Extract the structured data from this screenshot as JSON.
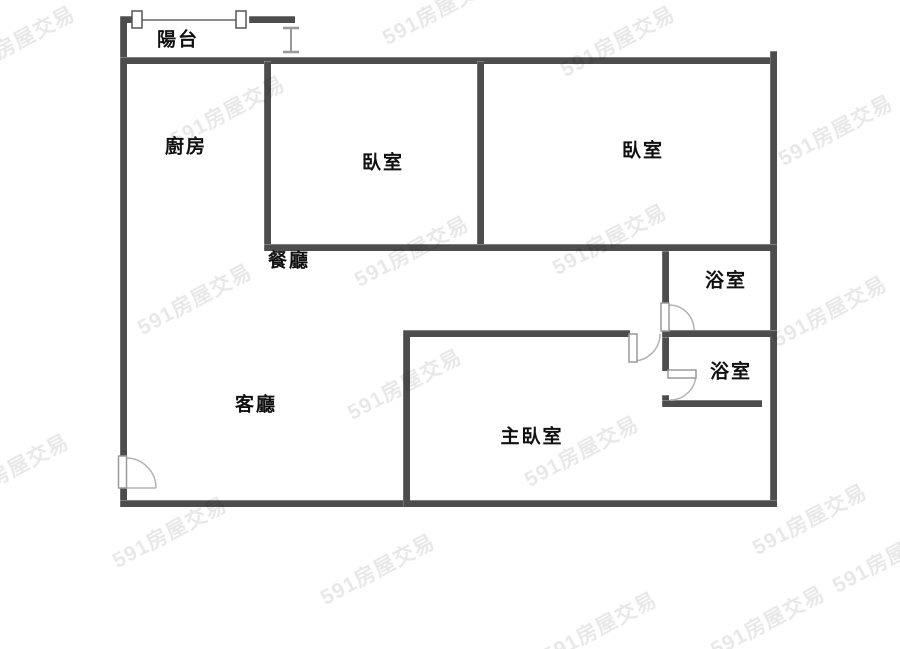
{
  "page": {
    "width": 900,
    "height": 649,
    "background": "#ffffff"
  },
  "colors": {
    "wall": "#4d4d4d",
    "window_line": "#8c8c8c",
    "door_arc": "#b3b3b3",
    "door_leaf_border": "#9a9a9a",
    "label_text": "#111111",
    "watermark_text": "rgba(0,0,0,0.09)"
  },
  "watermark": {
    "text": "591房屋交易"
  },
  "rooms": [
    {
      "name": "balcony",
      "label": "陽台"
    },
    {
      "name": "kitchen",
      "label": "廚房"
    },
    {
      "name": "bedroom-1",
      "label": "臥室"
    },
    {
      "name": "bedroom-2",
      "label": "臥室"
    },
    {
      "name": "dining-room",
      "label": "餐廳"
    },
    {
      "name": "bathroom-1",
      "label": "浴室"
    },
    {
      "name": "bathroom-2",
      "label": "浴室"
    },
    {
      "name": "living-room",
      "label": "客廳"
    },
    {
      "name": "master-bedroom",
      "label": "主臥室"
    }
  ]
}
